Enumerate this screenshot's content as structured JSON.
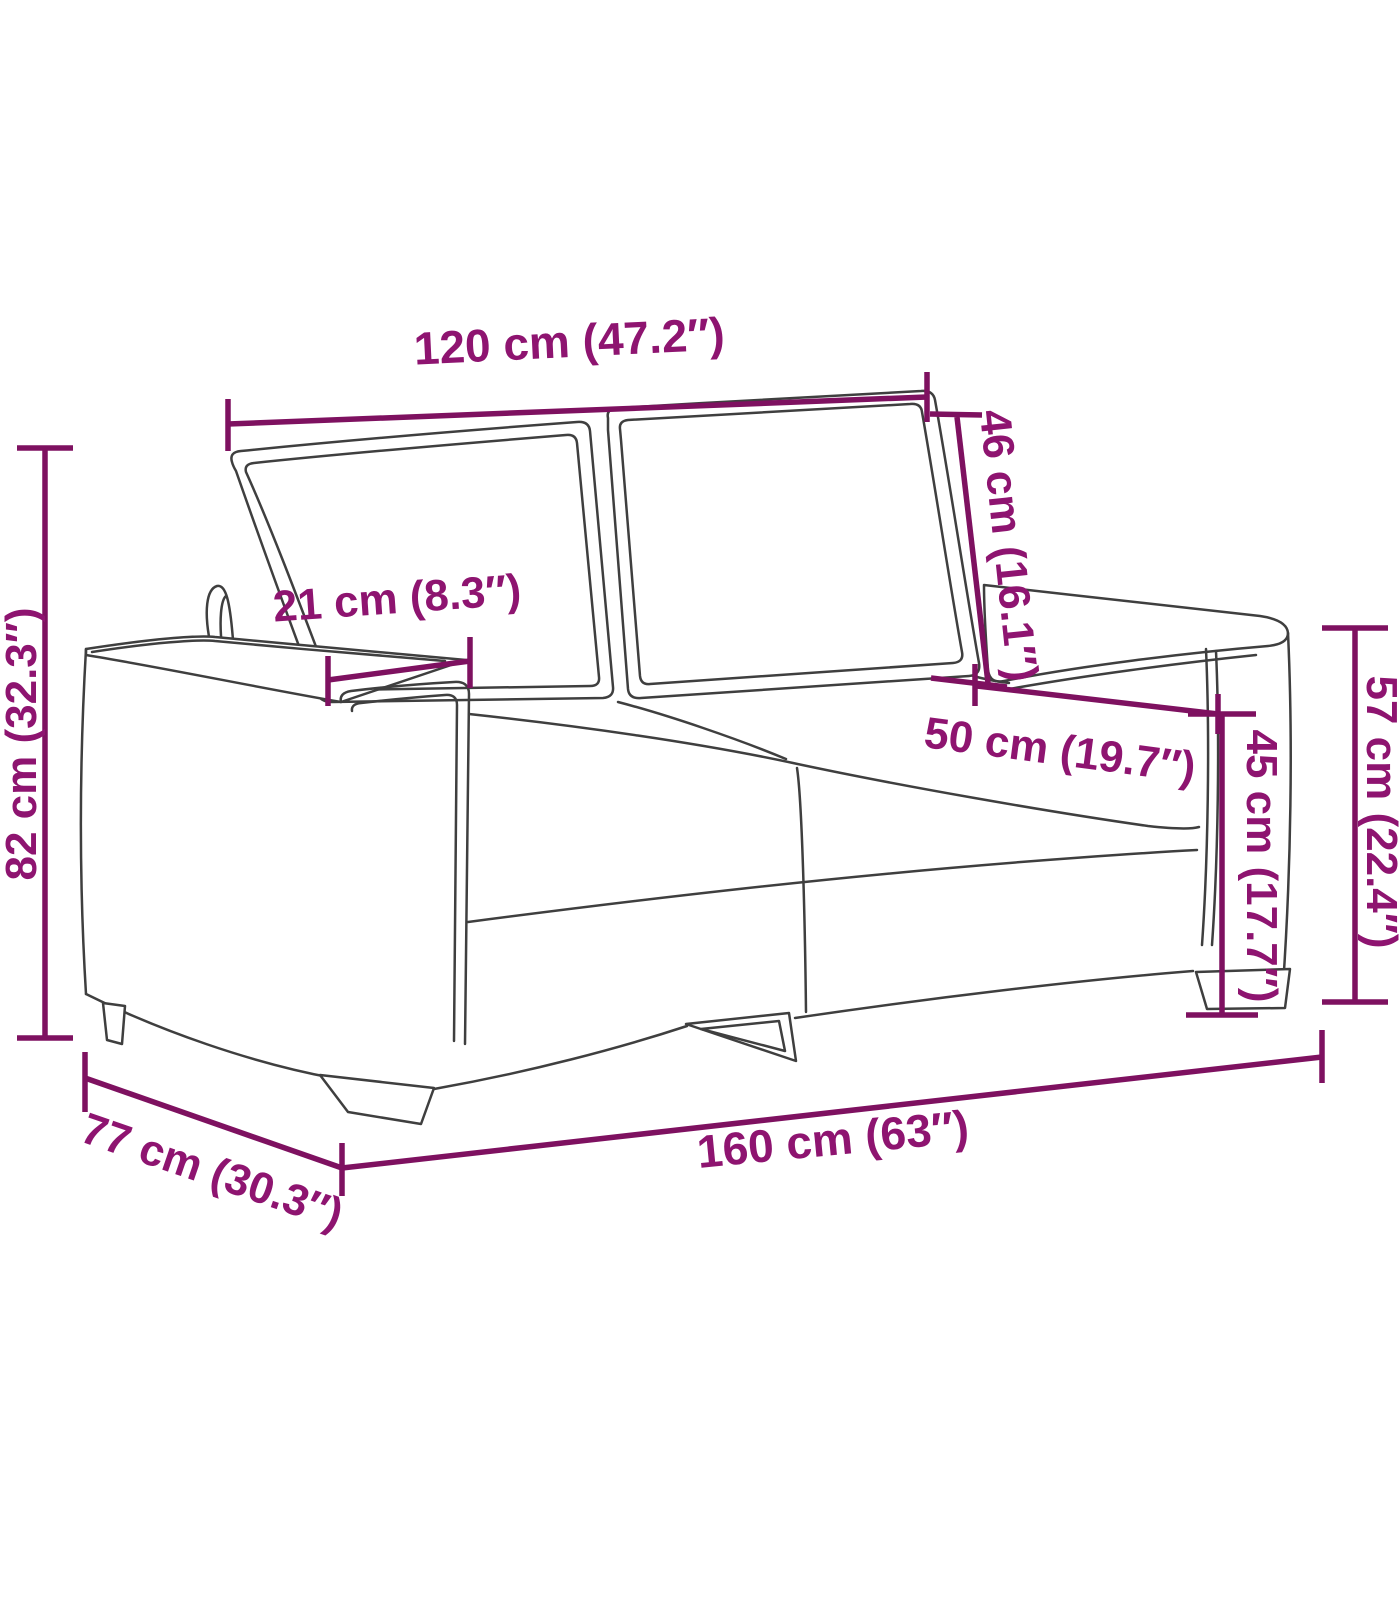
{
  "diagram": {
    "type": "furniture-dimension-diagram",
    "subject": "two-seater sofa line drawing with measurement annotations",
    "background_color": "#ffffff",
    "drawing_line_color": "#3f3f3f",
    "dimension_color": "#8e1470",
    "dimensions": [
      {
        "id": "backrest-width",
        "label": "120 cm (47.2″)",
        "cm": 120,
        "inches": 47.2
      },
      {
        "id": "backrest-height",
        "label": "46 cm (16.1″)",
        "cm": 46,
        "inches": 16.1
      },
      {
        "id": "overall-height",
        "label": "82 cm (32.3″)",
        "cm": 82,
        "inches": 32.3
      },
      {
        "id": "armrest-width",
        "label": "21 cm (8.3″)",
        "cm": 21,
        "inches": 8.3
      },
      {
        "id": "seat-depth",
        "label": "50 cm (19.7″)",
        "cm": 50,
        "inches": 19.7
      },
      {
        "id": "seat-height",
        "label": "45 cm (17.7″)",
        "cm": 45,
        "inches": 17.7
      },
      {
        "id": "armrest-height",
        "label": "57 cm (22.4″)",
        "cm": 57,
        "inches": 22.4
      },
      {
        "id": "overall-width",
        "label": "160 cm (63″)",
        "cm": 160,
        "inches": 63
      },
      {
        "id": "overall-depth",
        "label": "77 cm (30.3″)",
        "cm": 77,
        "inches": 30.3
      }
    ]
  }
}
